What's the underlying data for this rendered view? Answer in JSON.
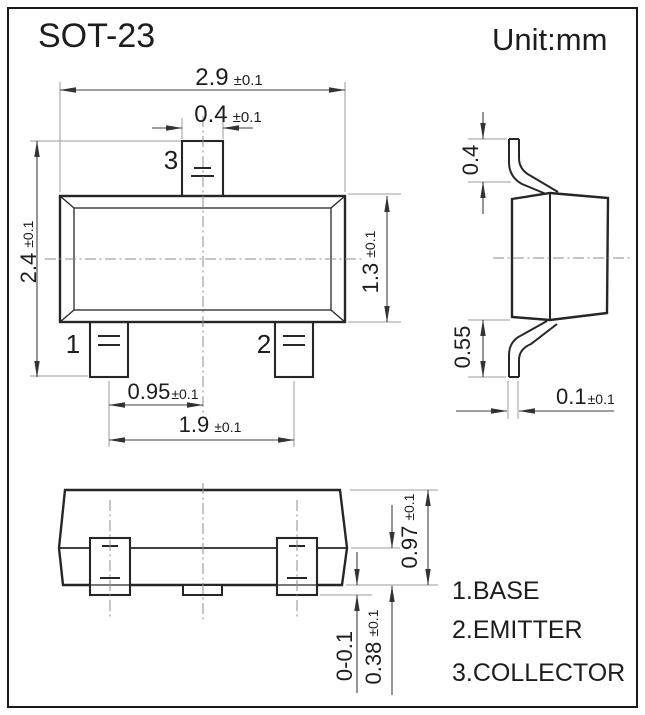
{
  "title": "SOT-23",
  "unit": "Unit:mm",
  "pins": {
    "p1": "1",
    "p2": "2",
    "p3": "3"
  },
  "legend": [
    "1.BASE",
    "2.EMITTER",
    "3.COLLECTOR"
  ],
  "dims": {
    "body_width": {
      "v": "2.9",
      "t": "±0.1"
    },
    "pin3_width": {
      "v": "0.4",
      "t": "±0.1"
    },
    "overall_height": {
      "v": "2.4",
      "t": "±0.1"
    },
    "body_height": {
      "v": "1.3",
      "t": "±0.1"
    },
    "pin_center_offset": {
      "v": "0.95",
      "t": "±0.1"
    },
    "pin_pitch": {
      "v": "1.9",
      "t": "±0.1"
    },
    "lead_top_bend": {
      "v": "0.4",
      "t": ""
    },
    "lead_bottom_bend": {
      "v": "0.55",
      "t": ""
    },
    "lead_thickness": {
      "v": "0.1",
      "t": "±0.1"
    },
    "body_depth": {
      "v": "0.97",
      "t": "±0.1"
    },
    "lead_width": {
      "v": "0.38",
      "t": "±0.1"
    },
    "lead_protrusion": {
      "v": "0-0.1",
      "t": ""
    }
  },
  "colors": {
    "line": "#262626",
    "background": "#ffffff"
  }
}
